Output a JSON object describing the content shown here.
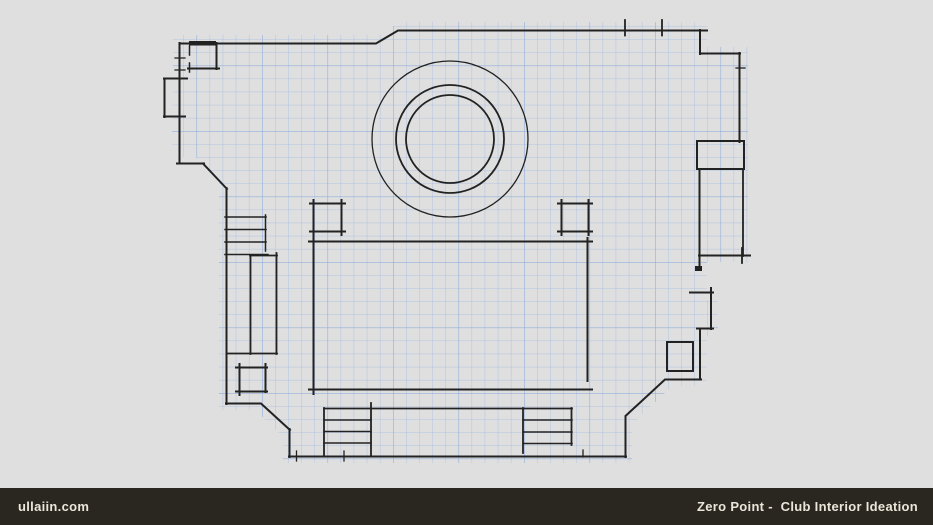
{
  "page": {
    "width": 933,
    "height": 525,
    "background": "#dfdfdf"
  },
  "drawing": {
    "line_color": "#222222",
    "grid_color": "#a6bfe3",
    "grid_strong_color": "#8fadd9"
  },
  "footer": {
    "background": "#2a2620",
    "text_color": "#ebe6da",
    "site": "ullaiin.com",
    "title": "Zero Point -  Club Interior Ideation"
  }
}
